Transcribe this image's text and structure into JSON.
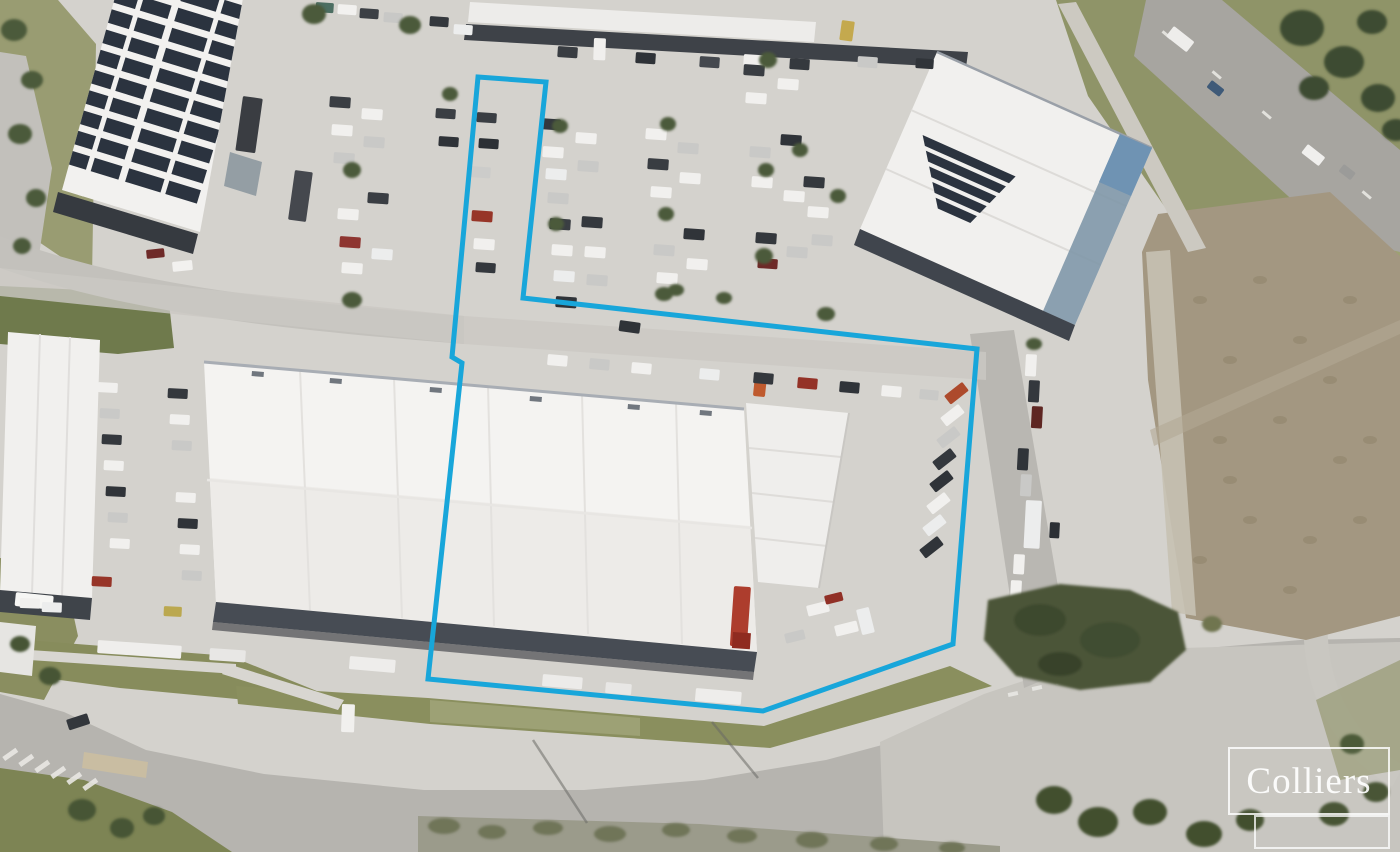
{
  "watermark": {
    "brand": "Colliers"
  },
  "boundary": {
    "color": "#18a6da",
    "stroke_width": 5,
    "points": "478,77 546,82 523,298 977,349 953,644 763,711 428,679 462,363 452,357"
  },
  "colors": {
    "concrete": "#d4d2cd",
    "asphalt": "#b6b4af",
    "grass": "#7f8756",
    "dirt_lot": "#a39781",
    "roof_white": "#f3f2f0",
    "solar_panel": "#2b333f",
    "awning_shadow": "#474c54",
    "tree_green": "#4c5a3a",
    "boundary_blue": "#18a6da"
  }
}
